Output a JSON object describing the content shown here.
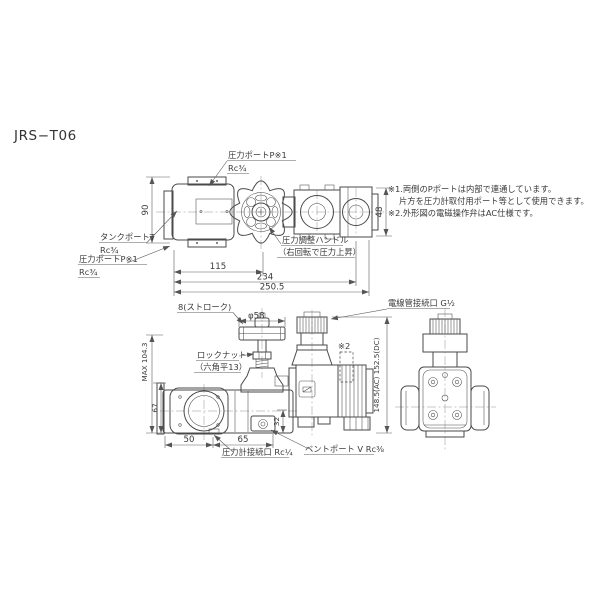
{
  "meta": {
    "title": "JRS−T06"
  },
  "colors": {
    "background": "#ffffff",
    "line": "#4a4a4a",
    "text": "#3a3a3a"
  },
  "notes": {
    "note1_line1": "※1.両側のPポートは内部で連通しています。",
    "note1_line2": "片方を圧力計取付用ポート等として使用できます。",
    "note2": "※2.外形図の電磁操作弁はAC仕様です。"
  },
  "top_view": {
    "labels": {
      "pressure_port_top": {
        "line1": "圧力ポートP※1",
        "line2": "Rc¾"
      },
      "tank_port": {
        "line1": "タンクポートT",
        "line2": "Rc¾"
      },
      "pressure_port_bottom": {
        "line1": "圧力ポートP※1",
        "line2": "Rc¾"
      },
      "adjust_handle": {
        "line1": "圧力調整ハンドル",
        "line2": "（右回転で圧力上昇）"
      }
    },
    "dims": {
      "body_height": "90",
      "solenoid_width": "48",
      "len_115": "115",
      "len_234": "234",
      "len_250_5": "250.5"
    }
  },
  "front_view": {
    "labels": {
      "stroke": "8(ストローク)",
      "handwheel_dia": "φ58",
      "lock_nut": {
        "line1": "ロックナット",
        "line2": "（六角平13）"
      },
      "ref2": "※2",
      "conduit_port": "電線管接続口 G½",
      "gauge_port": "圧力計接続口 Rc¼",
      "vent_port": "ベントポート V Rc⅜"
    },
    "dims": {
      "max_height": "MAX 104.3",
      "body_height": "67",
      "w50": "50",
      "w65": "65",
      "h32": "32",
      "total_height": "148.5(AC) 152.5(DC)"
    }
  }
}
